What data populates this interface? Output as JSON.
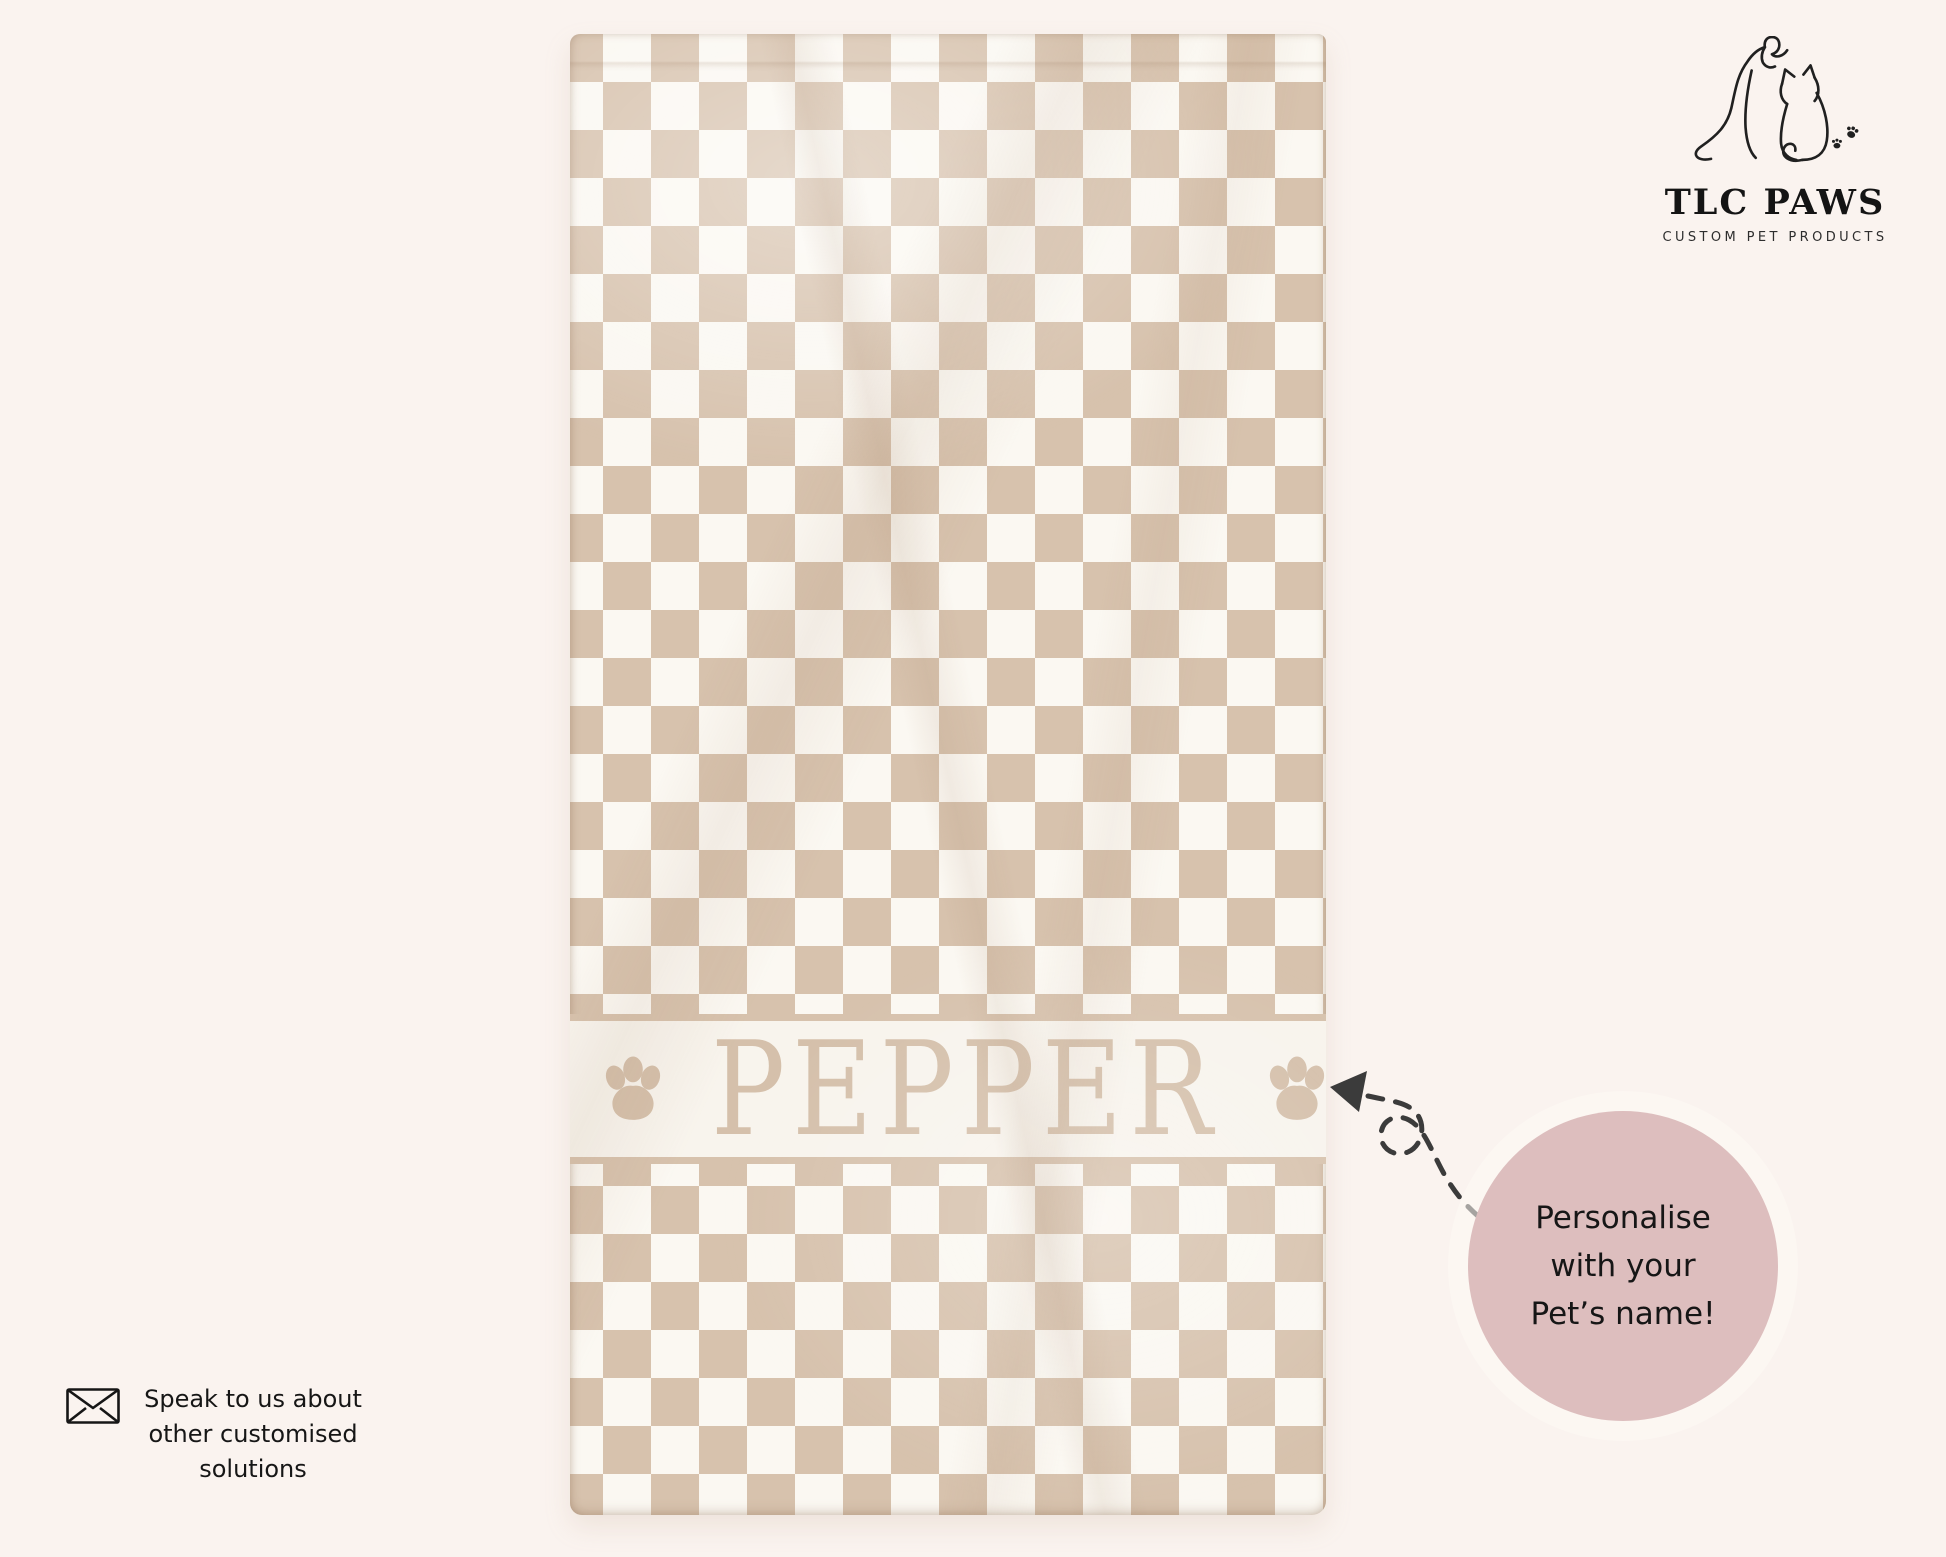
{
  "brand": {
    "name": "TLC PAWS",
    "tagline": "CUSTOM PET PRODUCTS"
  },
  "towel": {
    "pet_name": "PEPPER",
    "pattern": "checkerboard"
  },
  "callout": {
    "lines": [
      "Personalise",
      "with your",
      "Pet’s name!"
    ]
  },
  "contact": {
    "lines": [
      "Speak to us about",
      "other customised",
      "solutions"
    ]
  },
  "icons": {
    "brand_logo": "dog-cat-line-art",
    "name_band": "paw-print",
    "callout_pointer": "dashed-arrow-with-loop",
    "contact": "envelope"
  },
  "colors": {
    "background": "#FAF3EF",
    "checker_beige": "#D7C2AD",
    "checker_cream": "#FBF8F2",
    "band_bg": "#F8F4ED",
    "name_accent": "#D5C0AB",
    "callout_circle": "#DDBEBE",
    "ink": "#1A1A1A",
    "line_art": "#202020"
  }
}
